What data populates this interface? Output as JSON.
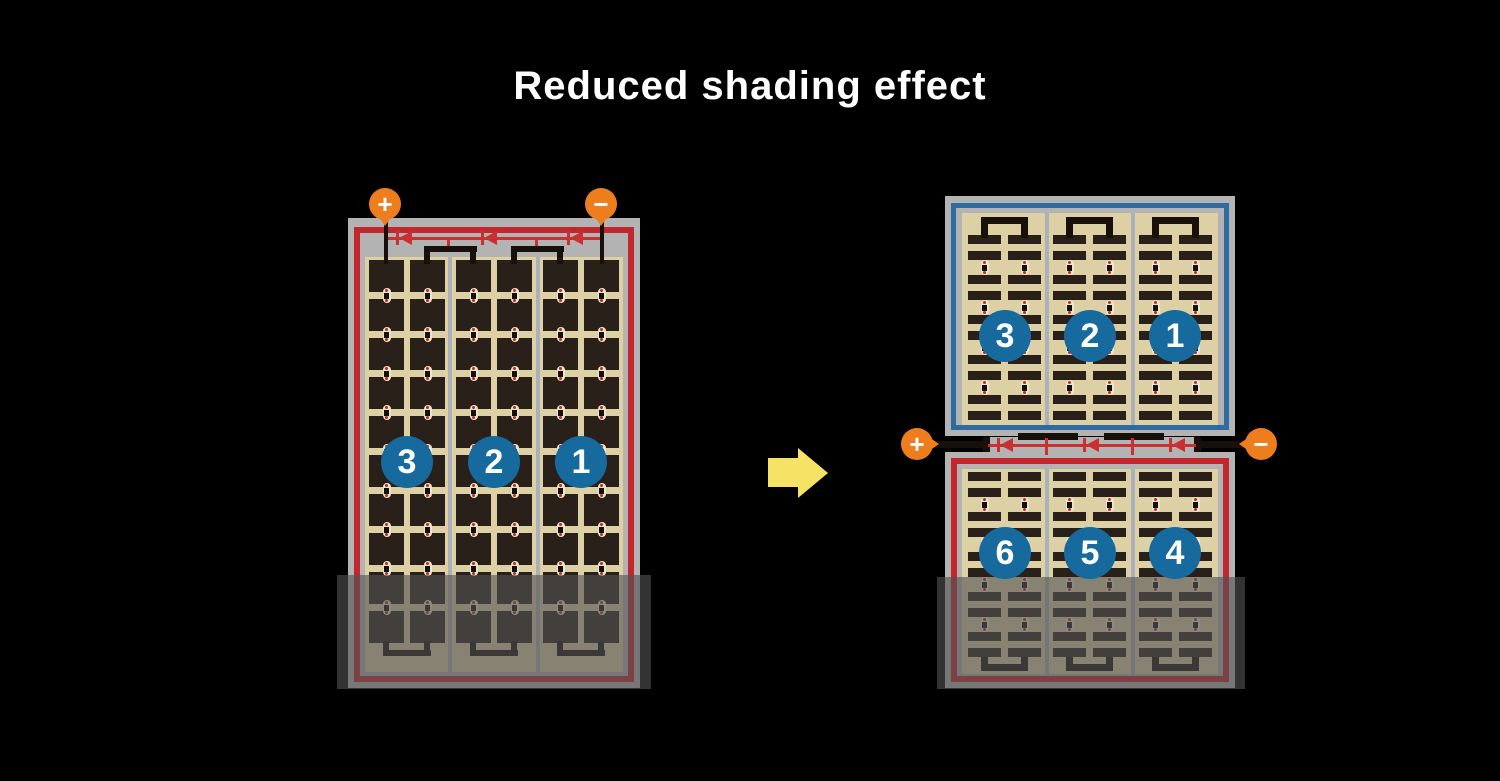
{
  "title": "Reduced shading effect",
  "colors": {
    "background": "#000000",
    "title_text": "#ffffff",
    "module_frame": "#b3b3b3",
    "cell_field": "#ddd0a4",
    "cell": "#29201a",
    "string_border_red": "#c1272d",
    "string_border_blue": "#2d6ba0",
    "bus_wire_red": "#c9302f",
    "interconnect_black": "#17100b",
    "terminal_orange": "#ee7d1d",
    "badge_blue": "#166a9e",
    "arrow_yellow": "#f6e365",
    "divider_gray": "#a9b2ba",
    "dot_cream": "#eee6c6",
    "dot_red": "#c1272d",
    "shade_overlay": "rgba(82,82,82,0.62)"
  },
  "left_module": {
    "description": "full-cell module, one string border",
    "cell_rows": 10,
    "cell_columns": 6,
    "shaded_rows": 2,
    "terminals": [
      {
        "symbol": "+",
        "polarity": "positive"
      },
      {
        "symbol": "−",
        "polarity": "negative"
      }
    ],
    "strings": [
      {
        "number": "3"
      },
      {
        "number": "2"
      },
      {
        "number": "1"
      }
    ],
    "bypass_diodes": 3,
    "shaded": true
  },
  "right_module": {
    "description": "half-cut-cell module, two independent halves",
    "bar_rows_per_half": 10,
    "bar_columns": 6,
    "top_half": {
      "border": "blue",
      "strings": [
        {
          "number": "3"
        },
        {
          "number": "2"
        },
        {
          "number": "1"
        }
      ]
    },
    "bottom_half": {
      "border": "red",
      "strings": [
        {
          "number": "6"
        },
        {
          "number": "5"
        },
        {
          "number": "4"
        }
      ]
    },
    "terminals": [
      {
        "symbol": "+",
        "polarity": "positive"
      },
      {
        "symbol": "−",
        "polarity": "negative"
      }
    ],
    "bypass_diodes": 3,
    "shaded": true
  },
  "arrow": {
    "direction": "right"
  }
}
